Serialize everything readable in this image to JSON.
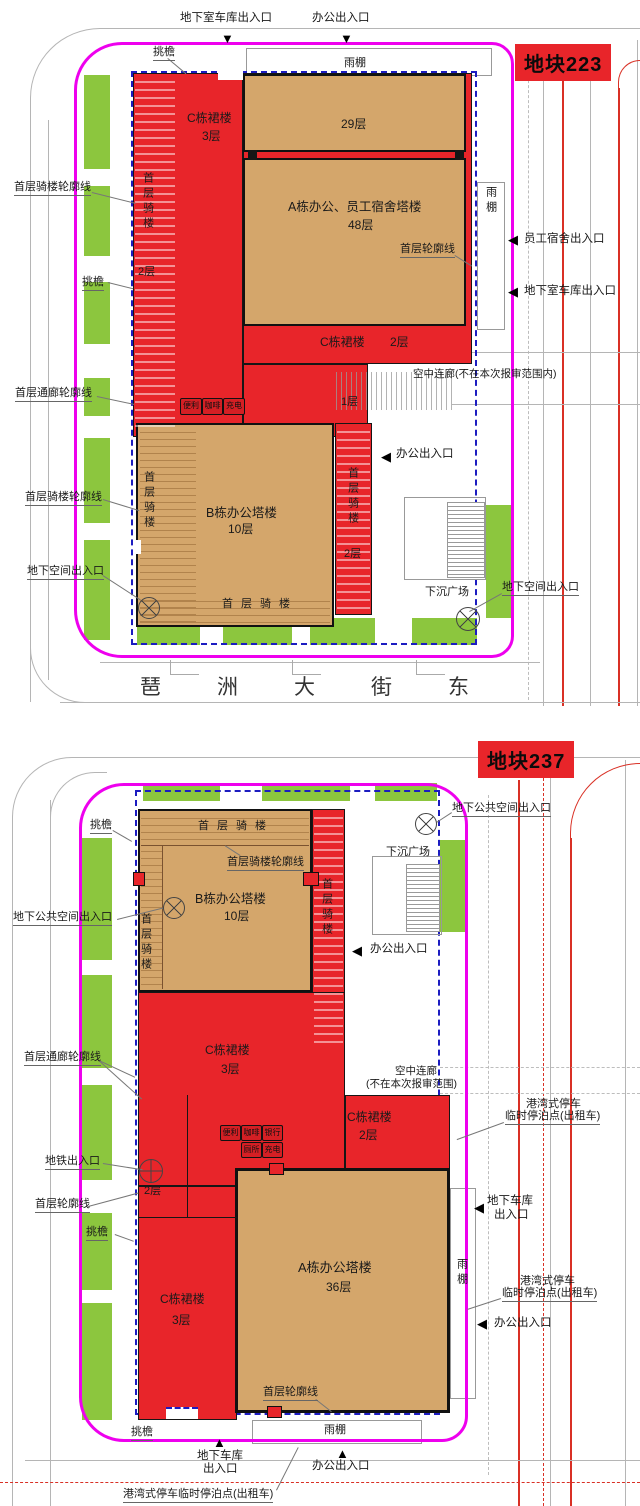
{
  "colors": {
    "building_red": "#e8252a",
    "tower_tan": "#d4a66b",
    "landscape_green": "#8cc63e",
    "boundary_magenta": "#ee00ee",
    "redline_blue": "#1c1cc0",
    "road_red": "#d93025",
    "road_gray": "#b5b5b5",
    "text": "#1a1a1a"
  },
  "p223": {
    "title": "地块223",
    "street_name": "琶洲大街东",
    "buildings": {
      "tower29_floors": "29层",
      "towerA_name": "A栋办公、员工宿舍塔楼",
      "towerA_floors": "48层",
      "towerB_name": "B栋办公塔楼",
      "towerB_floors": "10层",
      "podiumC_left_name": "C栋裙楼",
      "podiumC_left_floors": "3层",
      "podiumC_mid_name": "C栋裙楼",
      "podiumC_mid_floors": "2层",
      "podium_floor1": "1层",
      "arcade_floors2_left": "2层",
      "arcade_floors2_right": "2层"
    },
    "services": [
      "便利",
      "咖啡",
      "充电"
    ],
    "labels": {
      "garage_top": "地下室车库出入口",
      "office_top": "办公出入口",
      "eave_top": "挑檐",
      "canopy_top": "雨棚",
      "canopy_right": "雨棚",
      "dorm_entrance": "员工宿舍出入口",
      "garage_right": "地下室车库出入口",
      "first_floor_outline": "首层轮廓线",
      "arcade_outline_upper": "首层骑楼轮廓线",
      "arcade_left_v": "首层骑楼",
      "eave_left": "挑檐",
      "corridor_outline": "首层通廊轮廓线",
      "sky_corridor": "空中连廊(不在本次报审范围内)",
      "office_mid": "办公出入口",
      "arcade_outline_lower": "首层骑楼轮廓线",
      "arcade_towerB_v": "首层骑楼",
      "arcade_right_v": "首层骑楼",
      "underground_left": "地下空间出入口",
      "underground_right": "地下空间出入口",
      "sunken_plaza": "下沉广场",
      "arcade_bottom": "首层骑楼"
    }
  },
  "p237": {
    "title": "地块237",
    "buildings": {
      "towerA_name": "A栋办公塔楼",
      "towerA_floors": "36层",
      "towerB_name": "B栋办公塔楼",
      "towerB_floors": "10层",
      "podiumC_upper_name": "C栋裙楼",
      "podiumC_upper_floors": "3层",
      "podiumC_right_name": "C栋裙楼",
      "podiumC_right_floors": "2层",
      "podiumC_lower_name": "C栋裙楼",
      "podiumC_lower_floors": "3层",
      "arcade_floors2": "2层"
    },
    "services_row1": [
      "便利",
      "咖啡",
      "银行"
    ],
    "services_row2": [
      "厕所",
      "充电"
    ],
    "labels": {
      "underground_public_top": "地下公共空间出入口",
      "underground_public_left": "地下公共空间出入口",
      "eave_top_left": "挑檐",
      "arcade_top": "首层骑楼",
      "arcade_outline": "首层骑楼轮廓线",
      "arcade_left_v": "首层骑楼",
      "arcade_right_v": "首层骑楼",
      "sunken_plaza": "下沉广场",
      "office_mid": "办公出入口",
      "corridor_outline": "首层通廊轮廓线",
      "sky_corridor_line1": "空中连廊",
      "sky_corridor_line2": "(不在本次报审范围)",
      "bay_parking_line1": "港湾式停车",
      "bay_parking_line2": "临时停泊点(出租车)",
      "metro_entrance": "地铁出入口",
      "first_outline_left": "首层轮廓线",
      "eave_mid_left": "挑檐",
      "garage_right_line1": "地下车库",
      "garage_right_line2": "出入口",
      "canopy_right": "雨棚",
      "office_right": "办公出入口",
      "first_outline_bottom": "首层轮廓线",
      "canopy_bottom": "雨棚",
      "eave_bottom": "挑檐",
      "garage_bottom_line1": "地下车库",
      "garage_bottom_line2": "出入口",
      "office_bottom": "办公出入口",
      "bay_parking_bottom": "港湾式停车临时停泊点(出租车)"
    }
  }
}
